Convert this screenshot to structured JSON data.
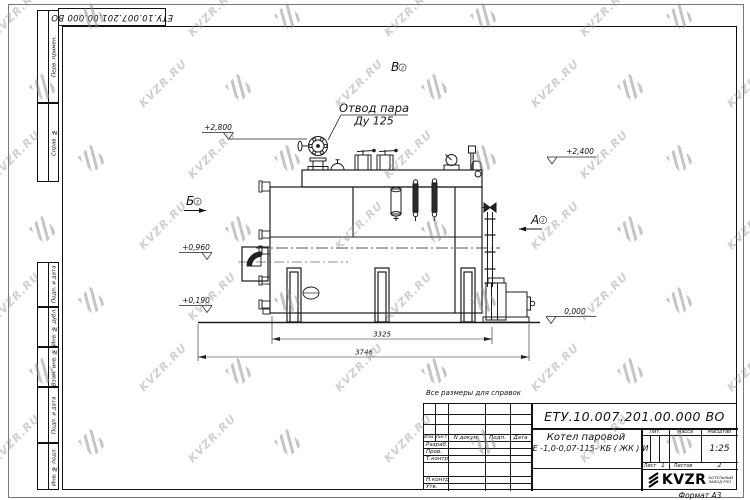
{
  "watermark": {
    "text": "KVZR.RU"
  },
  "doc_number": "ЕТУ.10.007.201.00.000  ВО",
  "margin_labels": [
    "Перв. примен.",
    "Справ. №",
    "Подп. и дата",
    "Инв. № дубл.",
    "Взам. инв. №",
    "Подп. и дата",
    "Инв. № подл."
  ],
  "drawing": {
    "note": "Все размеры для справок",
    "steam_outlet": {
      "line1": "Отвод пара",
      "line2": "Ду 125"
    },
    "views": {
      "a": "А",
      "b": "Б",
      "v": "В",
      "sheet_ref": "2"
    },
    "elevations": {
      "valve_top": "+2,800",
      "boiler_top": "+2,400",
      "mid": "+0,960",
      "low": "+0,190",
      "ground": "0,000"
    },
    "dimensions": {
      "boiler_length": "3325",
      "overall_length": "3746"
    }
  },
  "title_block": {
    "doc_number": "ЕТУ.10.007.201.00.000  ВО",
    "product_name_line1": "Котел паровой",
    "product_name_line2": "Е -1,0-0,07-115- КБ ( ЖК )",
    "columns": {
      "izm": "Изм.",
      "list": "Лист",
      "doc": "N докум.",
      "podp": "Подп.",
      "data": "Дата"
    },
    "roles": {
      "developed": "Разраб.",
      "checked": "Пров.",
      "tcontrol": "Т.контр.",
      "ncontrol": "Н.контр.",
      "approved": "Утв."
    },
    "lit_header": "Лит.",
    "mass_header": "Масса",
    "scale_header": "Масштаб",
    "lit_value": "И",
    "scale_value": "1:25",
    "sheet_label": "Лист",
    "sheet_value": "1",
    "sheets_label": "Листов",
    "sheets_value": "2",
    "logo_text": "KVZR",
    "logo_sub1": "КОТЕЛЬНЫЙ",
    "logo_sub2": "ЗАВОД РЭП",
    "format": "Формат А3"
  }
}
